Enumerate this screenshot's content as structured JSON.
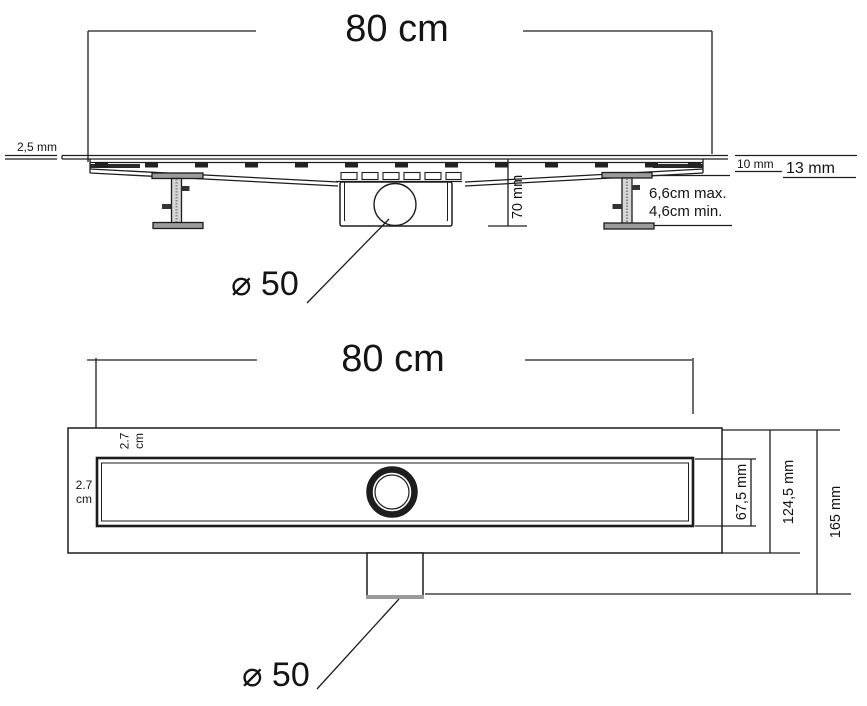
{
  "drawing": {
    "type": "linear-shower-drain-technical-drawing"
  },
  "side_view": {
    "length_label": "80 cm",
    "plate_thickness_label": "2,5 mm",
    "tile_thickness_label": "10 mm",
    "total_height_label": "13 mm",
    "trap_depth_label": "70 mm",
    "leg_height_max_label": "6,6cm max.",
    "leg_height_min_label": "4,6cm min.",
    "outlet_diameter_label": "⌀ 50"
  },
  "plan_view": {
    "length_label": "80 cm",
    "top_edge_width_value": "2.7",
    "top_edge_width_unit": "cm",
    "left_edge_width_value": "2.7",
    "left_edge_width_unit": "cm",
    "grate_width_label": "67,5 mm",
    "body_width_label": "124,5 mm",
    "overall_width_label": "165 mm",
    "outlet_diameter_label": "⌀ 50"
  },
  "colors": {
    "line": "#1d1d1d",
    "metal_gray": "#9b9b9b",
    "stem_gray": "#d6d6d6",
    "background": "#ffffff"
  }
}
